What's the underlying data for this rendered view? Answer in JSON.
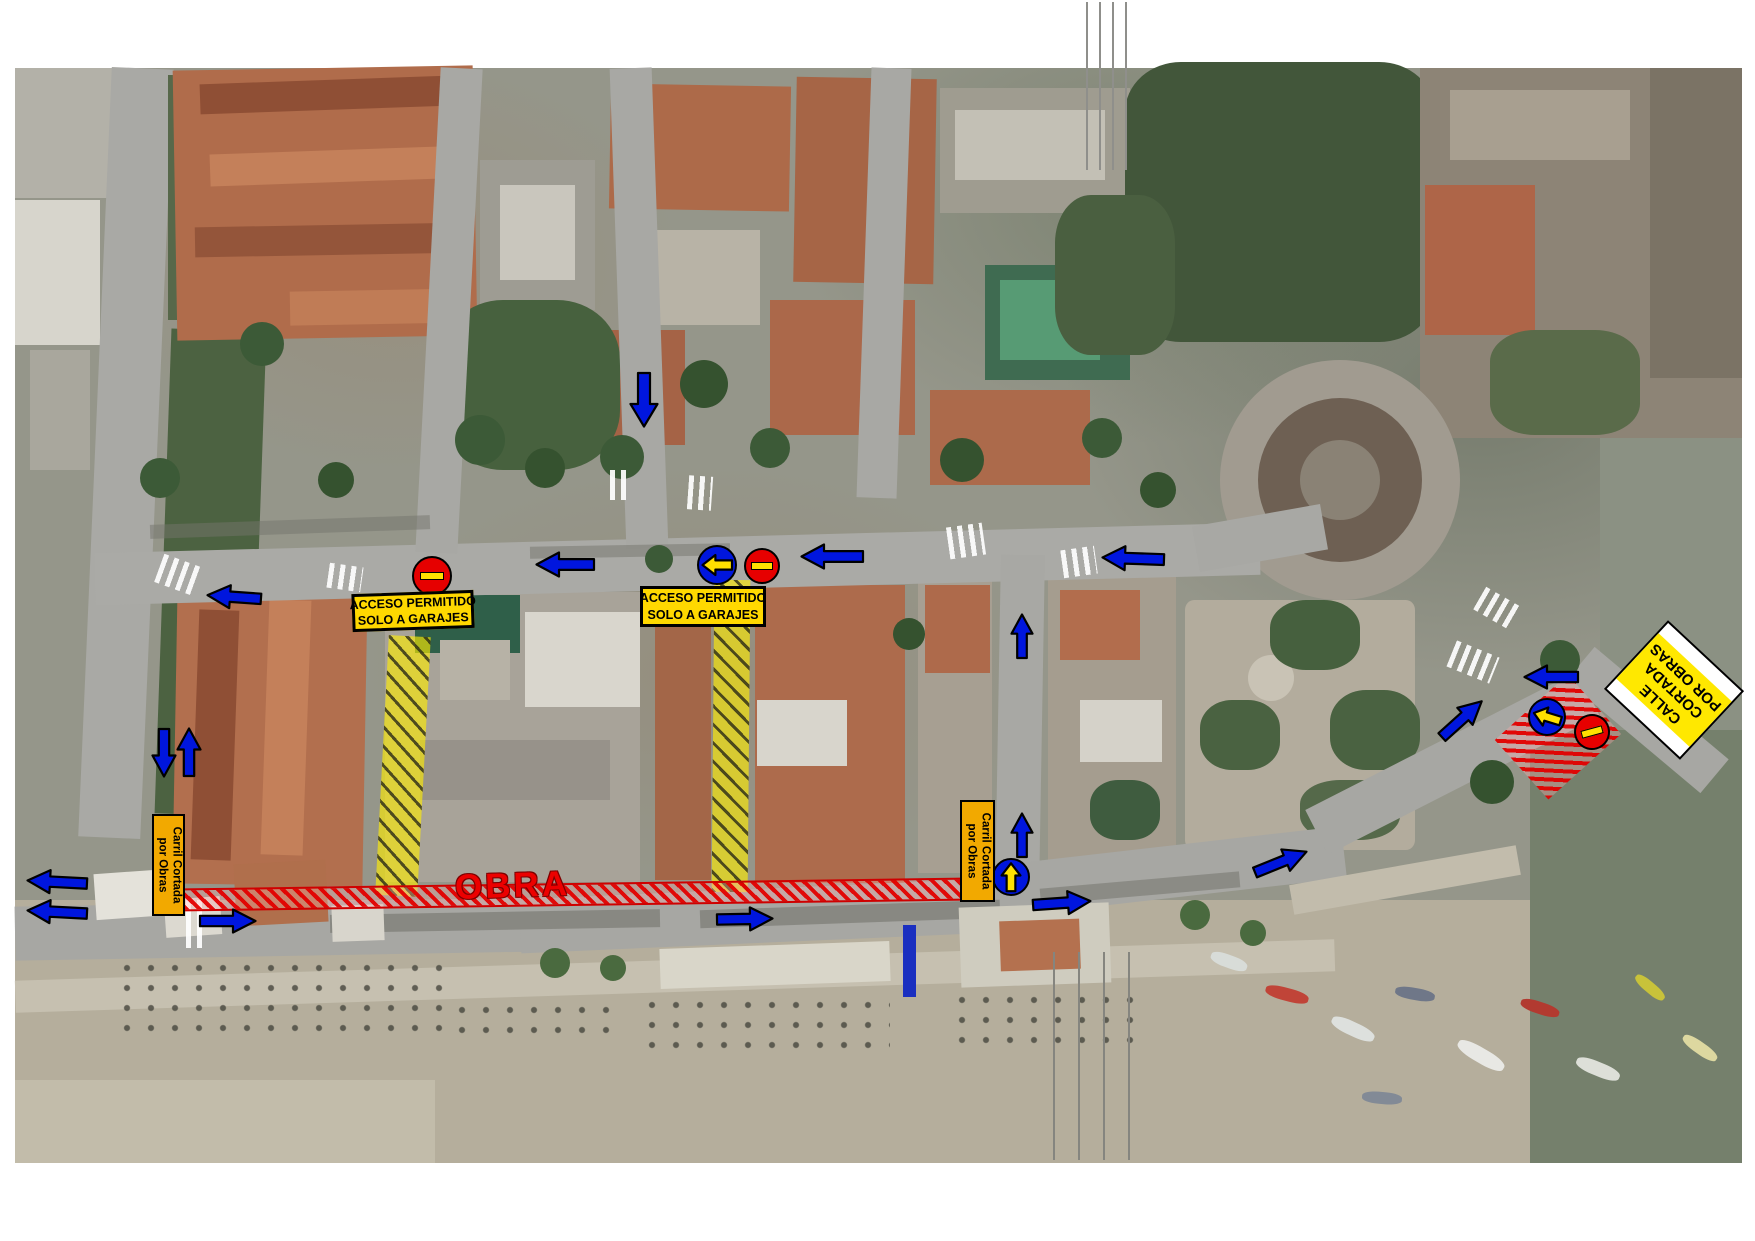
{
  "labels": {
    "acceso_line1": "ACCESO PERMITIDO",
    "acceso_line2": "SOLO A GARAJES",
    "carril_line1": "Carril Cortada",
    "carril_line2": "por Obras",
    "obra": "OBRA",
    "calle_line1": "CALLE",
    "calle_line2": "CORTADA",
    "calle_line3": "POR OBRAS"
  },
  "overlay": {
    "colors": {
      "arrow_blue": "#0016DE",
      "sign_red": "#E60000",
      "bar_yellow": "#FFE000",
      "box_yellow": "#FFD800",
      "carril_amber": "#F2A900",
      "calle_yellow": "#FFE800",
      "hatch_yellow": "rgba(255,238,0,0.62)",
      "hatch_red": "#E60000"
    },
    "arrows": [
      {
        "name": "arrow-down-top-street",
        "cx": 644,
        "cy": 400,
        "len": 56,
        "w": 30,
        "rot": 90
      },
      {
        "name": "arrow-left-main-street-1",
        "cx": 565,
        "cy": 564,
        "len": 60,
        "w": 27,
        "rot": 180
      },
      {
        "name": "arrow-left-main-street-2",
        "cx": 832,
        "cy": 556,
        "len": 64,
        "w": 27,
        "rot": 180
      },
      {
        "name": "arrow-left-main-street-3",
        "cx": 1133,
        "cy": 558,
        "len": 64,
        "w": 27,
        "rot": 182
      },
      {
        "name": "arrow-left-main-street-west",
        "cx": 234,
        "cy": 597,
        "len": 56,
        "w": 26,
        "rot": 184
      },
      {
        "name": "arrow-up-cross-street-north",
        "cx": 1022,
        "cy": 636,
        "len": 46,
        "w": 24,
        "rot": -90
      },
      {
        "name": "arrow-down-boulevard",
        "cx": 164,
        "cy": 753,
        "len": 50,
        "w": 26,
        "rot": 90
      },
      {
        "name": "arrow-up-boulevard",
        "cx": 189,
        "cy": 752,
        "len": 50,
        "w": 26,
        "rot": -90
      },
      {
        "name": "arrow-right-promenade-west",
        "cx": 228,
        "cy": 921,
        "len": 58,
        "w": 26,
        "rot": 0
      },
      {
        "name": "arrow-left-coastal-west-1",
        "cx": 57,
        "cy": 882,
        "len": 62,
        "w": 26,
        "rot": 183
      },
      {
        "name": "arrow-left-coastal-west-2",
        "cx": 57,
        "cy": 912,
        "len": 62,
        "w": 26,
        "rot": 183
      },
      {
        "name": "arrow-right-coastal-mid",
        "cx": 745,
        "cy": 919,
        "len": 58,
        "w": 26,
        "rot": -1
      },
      {
        "name": "arrow-right-coastal-east",
        "cx": 1062,
        "cy": 903,
        "len": 60,
        "w": 26,
        "rot": -4
      },
      {
        "name": "arrow-up-right-coastal",
        "cx": 1281,
        "cy": 862,
        "len": 58,
        "w": 26,
        "rot": -22
      },
      {
        "name": "arrow-up-cross-street-south",
        "cx": 1022,
        "cy": 835,
        "len": 46,
        "w": 24,
        "rot": -90
      },
      {
        "name": "arrow-left-roundabout-exit",
        "cx": 1551,
        "cy": 677,
        "len": 56,
        "w": 26,
        "rot": 180
      },
      {
        "name": "arrow-up-right-to-roundabout",
        "cx": 1462,
        "cy": 719,
        "len": 56,
        "w": 26,
        "rot": -42
      }
    ],
    "no_entry_signs": [
      {
        "name": "no-entry-main-street-west",
        "cx": 432,
        "cy": 576,
        "r": 20,
        "rot": 0
      },
      {
        "name": "no-entry-main-street-mid",
        "cx": 762,
        "cy": 566,
        "r": 18,
        "rot": 0
      },
      {
        "name": "no-entry-roundabout-south",
        "cx": 1592,
        "cy": 732,
        "r": 18,
        "rot": -15
      }
    ],
    "mandatory_signs": [
      {
        "name": "mandatory-left-main-street",
        "cx": 717,
        "cy": 565,
        "r": 20,
        "rot": 180
      },
      {
        "name": "mandatory-up-cross-street",
        "cx": 1011,
        "cy": 877,
        "r": 19,
        "rot": -90
      },
      {
        "name": "mandatory-left-roundabout-south",
        "cx": 1547,
        "cy": 717,
        "r": 19,
        "rot": 197
      }
    ],
    "closures": {
      "yellow_stripes": [
        {
          "name": "closed-street-west-hatch",
          "x": 382,
          "y": 636,
          "w": 42,
          "h": 260,
          "rot": 3
        },
        {
          "name": "closed-street-east-hatch",
          "x": 713,
          "y": 580,
          "w": 36,
          "h": 312,
          "rot": 0.5
        }
      ],
      "red_stripe": {
        "name": "obra-works-zone",
        "x": 184,
        "y": 883,
        "w": 778,
        "h": 23,
        "rot": -0.8
      },
      "red_area": {
        "name": "works-area-roundabout",
        "cx": 1558,
        "cy": 737,
        "w": 98,
        "h": 80,
        "rot": -42
      }
    }
  }
}
